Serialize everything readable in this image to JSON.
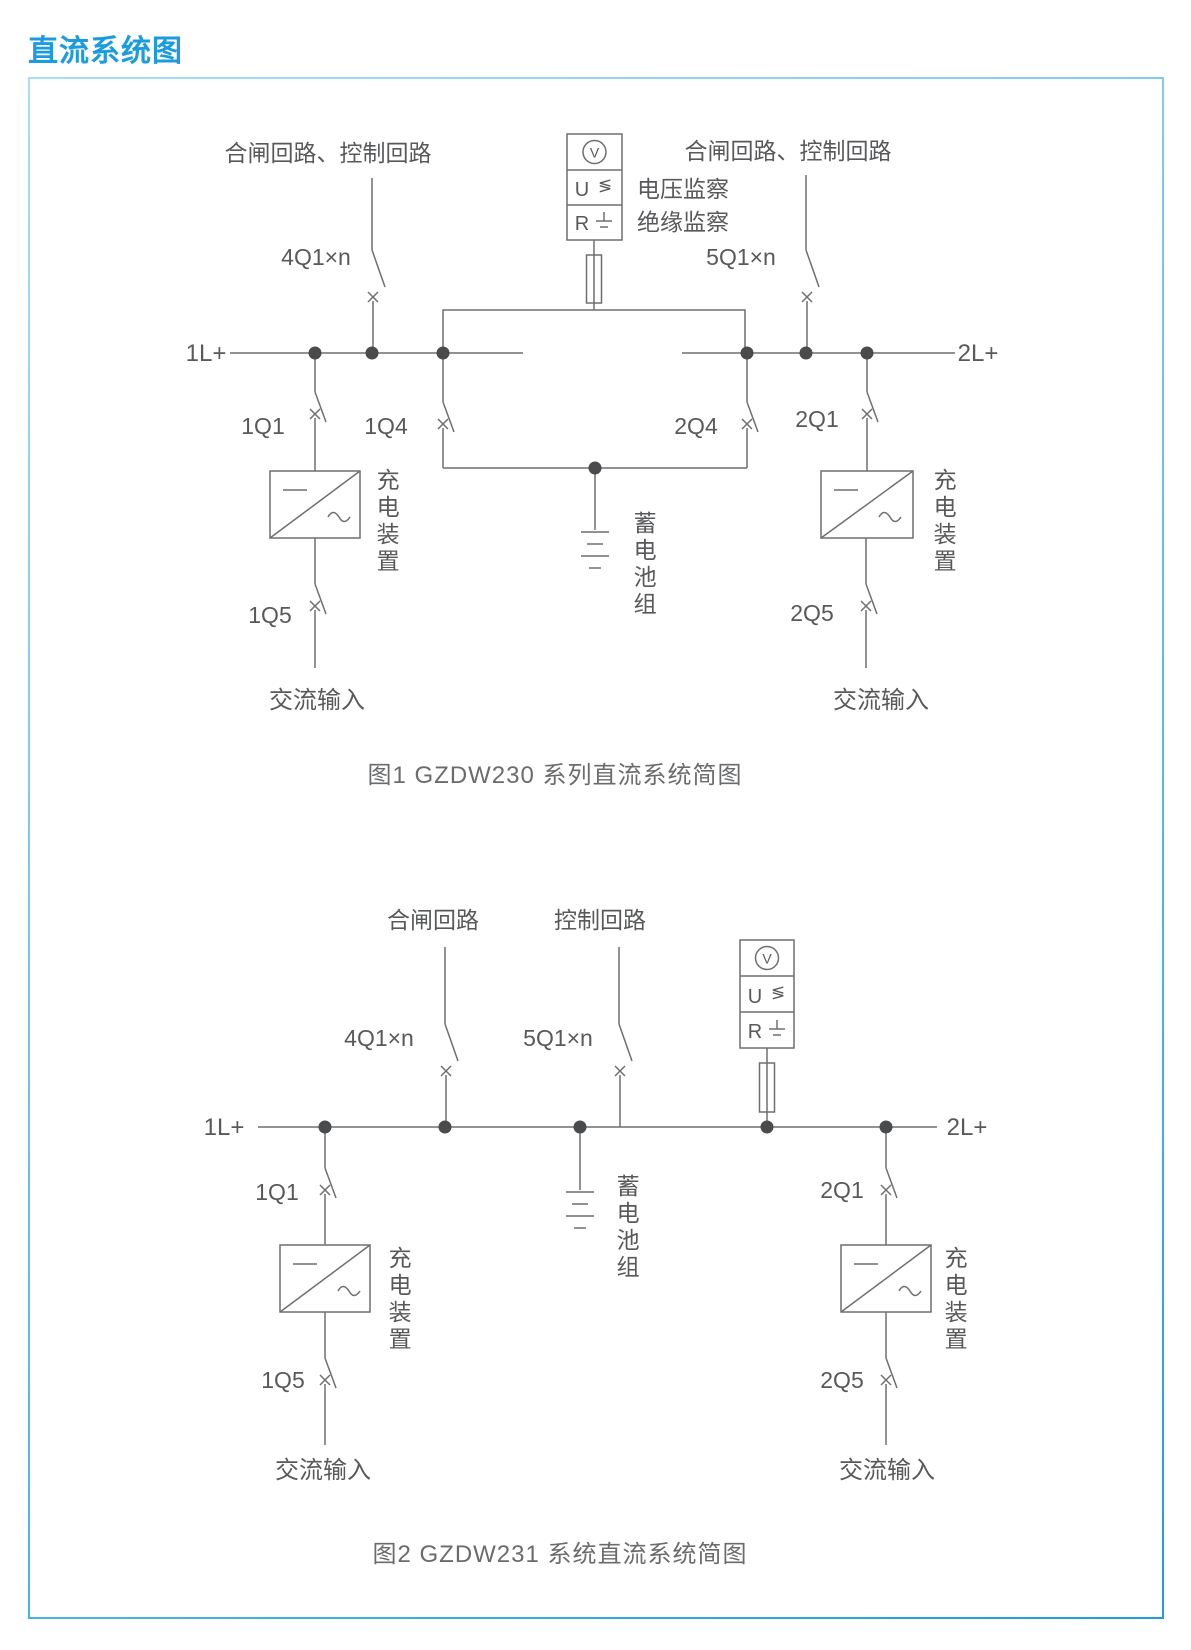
{
  "page": {
    "title": "直流系统图"
  },
  "colors": {
    "accent": "#1B9CE0",
    "border_light": "#AADDF5",
    "border_dark": "#1E9EE0",
    "line": "#6E6F71",
    "text": "#58595B",
    "dot": "#4A4B4D"
  },
  "fig1": {
    "caption": "图1 GZDW230 系列直流系统简图",
    "top_label_left": "合闸回路、控制回路",
    "top_label_right": "合闸回路、控制回路",
    "monitor": {
      "voltmeter": "V",
      "u": "U",
      "u_mark": "≶",
      "r": "R"
    },
    "voltage_monitor_label": "电压监察",
    "insulation_monitor_label": "绝缘监察",
    "feeder_left": "4Q1×n",
    "feeder_right": "5Q1×n",
    "bus_left": "1L+",
    "bus_right": "2L+",
    "breaker_1q1": "1Q1",
    "breaker_1q4": "1Q4",
    "breaker_2q4": "2Q4",
    "breaker_2q1": "2Q1",
    "breaker_1q5": "1Q5",
    "breaker_2q5": "2Q5",
    "charger_left": "充电装置",
    "charger_right": "充电装置",
    "battery": "蓄电池组",
    "ac_input_left": "交流输入",
    "ac_input_right": "交流输入"
  },
  "fig2": {
    "caption": "图2 GZDW231 系统直流系统简图",
    "top_label_left": "合闸回路",
    "top_label_right": "控制回路",
    "monitor": {
      "voltmeter": "V",
      "u": "U",
      "u_mark": "≶",
      "r": "R"
    },
    "feeder_left": "4Q1×n",
    "feeder_right": "5Q1×n",
    "bus_left": "1L+",
    "bus_right": "2L+",
    "breaker_1q1": "1Q1",
    "breaker_2q1": "2Q1",
    "breaker_1q5": "1Q5",
    "breaker_2q5": "2Q5",
    "charger_left": "充电装置",
    "charger_right": "充电装置",
    "battery": "蓄电池组",
    "ac_input_left": "交流输入",
    "ac_input_right": "交流输入"
  }
}
